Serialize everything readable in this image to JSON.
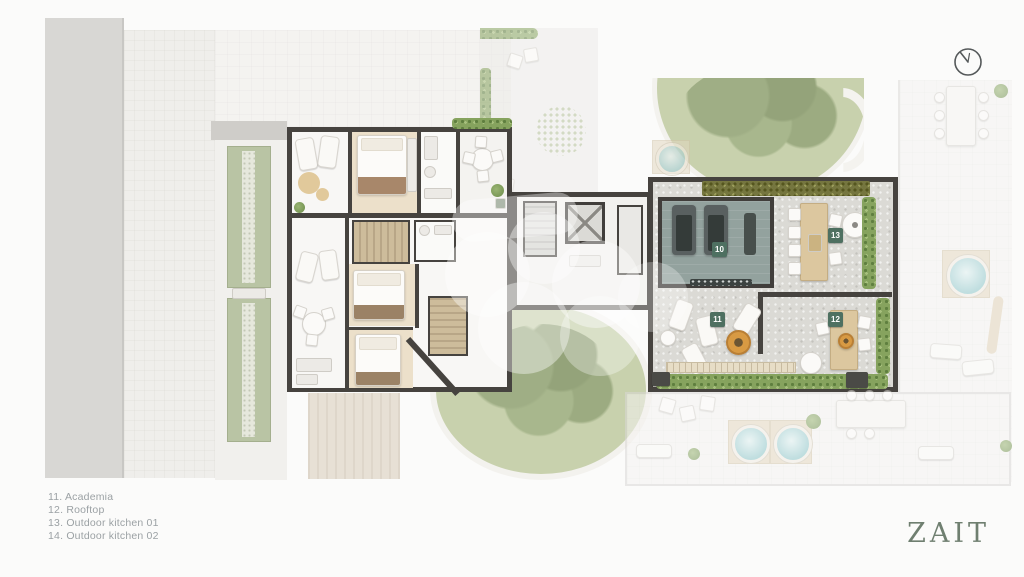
{
  "legend": {
    "items": [
      "11. Academia",
      "12. Rooftop",
      "13. Outdoor kitchen 01",
      "14. Outdoor kitchen 02"
    ]
  },
  "plan": {
    "badges": [
      {
        "id": "10",
        "room": "gym"
      },
      {
        "id": "11",
        "room": "rooftop-lounge"
      },
      {
        "id": "12",
        "room": "outdoor-kitchen-02"
      },
      {
        "id": "13",
        "room": "outdoor-kitchen-01"
      }
    ]
  },
  "icons": {
    "top_right": "north-indicator-icon"
  },
  "brand": {
    "logo": "ZAIT"
  },
  "colors": {
    "badge_green": "#4e7061",
    "firepit_gold": "#d89a43",
    "logo_green": "#6f7f70",
    "legend_gray": "#9ba1a4",
    "wall_dark": "#46433f",
    "gym_floor": "#93a29e",
    "wood_floor": "#ece0ca",
    "lawn_green": "#c8d1ad",
    "hedge_green": "#86a35e",
    "water_blue": "#8fc6c9"
  }
}
